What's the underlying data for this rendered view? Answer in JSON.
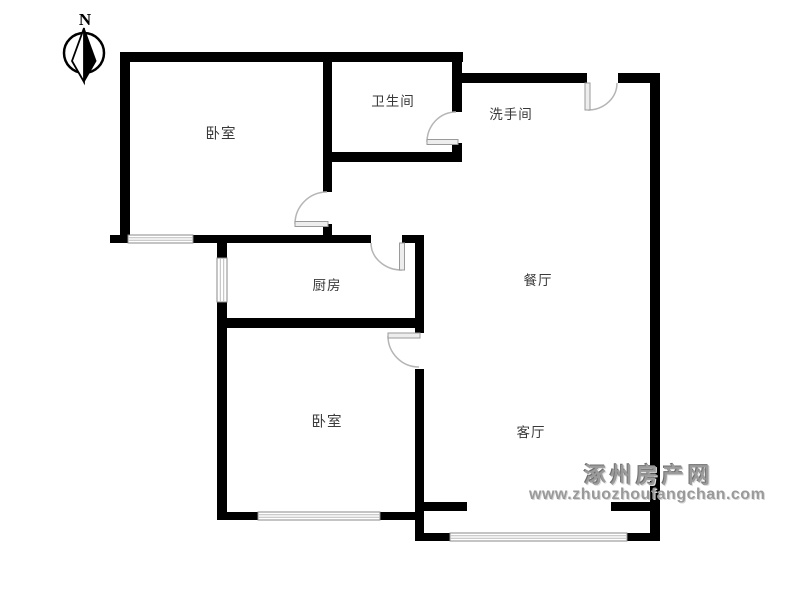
{
  "compass": {
    "north_label": "N"
  },
  "rooms": {
    "bedroom_top": {
      "label": "卧室"
    },
    "bathroom": {
      "label": "卫生间"
    },
    "washroom": {
      "label": "洗手间"
    },
    "kitchen": {
      "label": "厨房"
    },
    "dining": {
      "label": "餐厅"
    },
    "bedroom_bottom": {
      "label": "卧室"
    },
    "living": {
      "label": "客厅"
    }
  },
  "watermark": {
    "site_name": "涿州房产网",
    "site_url": "www.zhuozhoufangchan.com"
  },
  "colors": {
    "wall": "#000000",
    "door_arc": "#b5b5b5",
    "window_frame": "#8a8a8a",
    "label_text": "#3a3a3a",
    "watermark_gray": "#9b9b9b"
  }
}
